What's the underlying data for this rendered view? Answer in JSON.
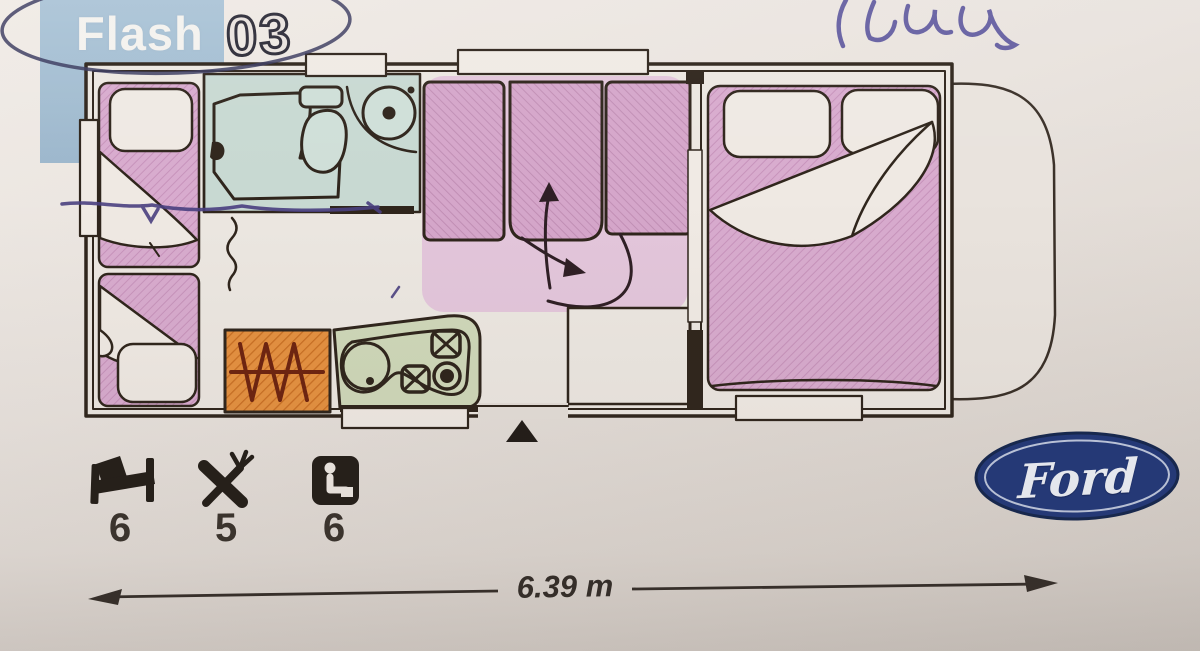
{
  "header": {
    "model_series": "Flash",
    "model_number": "03",
    "badge_color": "#a5bed2",
    "pen_circle_color": "#39395e"
  },
  "annotations": {
    "handwriting_color": "#57519b",
    "pen_underline_color": "#4a4080"
  },
  "floorplan": {
    "vehicle": "motorhome overhead plan",
    "line_color": "#2f251c",
    "rooms": [
      {
        "name": "bunk-beds-left",
        "color": "#d8abce",
        "features": [
          "upper bunk with pillow and blanket",
          "lower bunk with pillow and blanket",
          "side window"
        ]
      },
      {
        "name": "washroom",
        "color": "#c8d9d2",
        "features": [
          "shower tray with shower head",
          "toilet with cistern",
          "round basin with counter",
          "concertina door"
        ]
      },
      {
        "name": "dinette",
        "color": "#e3c6db",
        "features": [
          "three seat cushions",
          "bed conversion arrows",
          "overhead windows"
        ]
      },
      {
        "name": "kitchen",
        "color": "#cfd8b9",
        "features": [
          "round sink with drain",
          "two square burners with pan supports",
          "ring burner"
        ]
      },
      {
        "name": "heater-unit",
        "color": "#e59140",
        "features": [
          "zigzag heater symbol"
        ]
      },
      {
        "name": "wardrobe",
        "color": "#ece7e1",
        "features": [
          "cabinet below dinette"
        ]
      },
      {
        "name": "rear-double-bed",
        "color": "#d8abce",
        "features": [
          "two pillows",
          "turned-down white blanket",
          "bottom window"
        ]
      },
      {
        "name": "cab",
        "color": "none",
        "features": [
          "rounded cab outline at right"
        ]
      }
    ],
    "entry_marker": "black triangle at entrance door"
  },
  "specs": [
    {
      "name": "berths",
      "icon": "bed-icon",
      "value": "6"
    },
    {
      "name": "dining-places",
      "icon": "cutlery-icon",
      "value": "5"
    },
    {
      "name": "travel-seats",
      "icon": "seat-icon",
      "value": "6"
    }
  ],
  "dimension": {
    "label": "6.39 m"
  },
  "brand": {
    "name": "Ford",
    "oval_color": "#23397a",
    "text_color": "#eef1f8"
  }
}
